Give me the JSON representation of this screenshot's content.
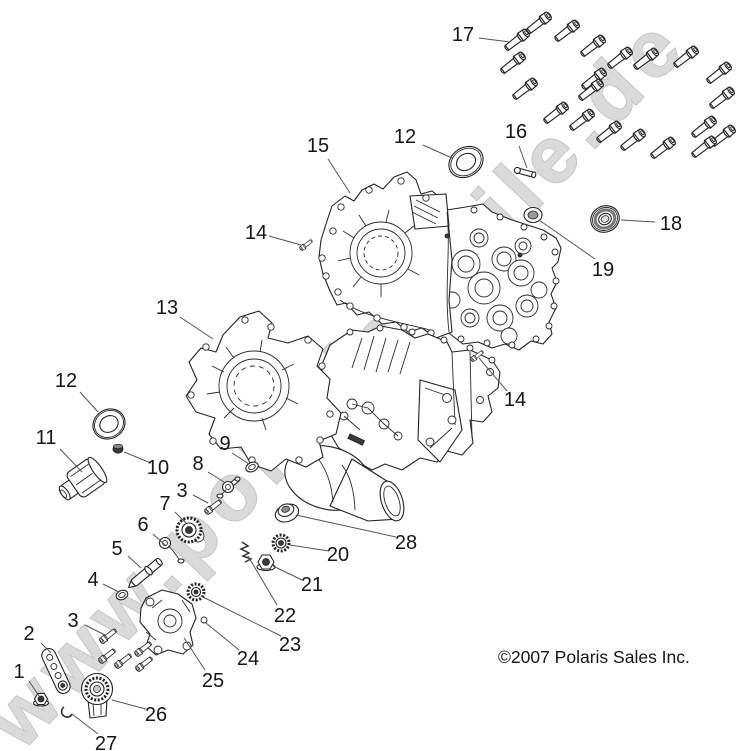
{
  "watermark": {
    "text": "www.polaris-teile.de"
  },
  "footer": {
    "copyright": "©2007 Polaris Sales Inc."
  },
  "diagram": {
    "title": "Polaris crankcase exploded parts diagram",
    "callouts": [
      {
        "n": "17",
        "lx": 463,
        "ly": 35,
        "x1": 479,
        "y1": 38,
        "x2": 510,
        "y2": 42
      },
      {
        "n": "12",
        "lx": 405,
        "ly": 137,
        "x1": 423,
        "y1": 145,
        "x2": 452,
        "y2": 158
      },
      {
        "n": "16",
        "lx": 516,
        "ly": 132,
        "x1": 519,
        "y1": 146,
        "x2": 527,
        "y2": 168
      },
      {
        "n": "15",
        "lx": 318,
        "ly": 146,
        "x1": 328,
        "y1": 159,
        "x2": 350,
        "y2": 193
      },
      {
        "n": "14",
        "lx": 256,
        "ly": 233,
        "x1": 269,
        "y1": 236,
        "x2": 301,
        "y2": 245
      },
      {
        "n": "18",
        "lx": 671,
        "ly": 224,
        "x1": 655,
        "y1": 222,
        "x2": 621,
        "y2": 220
      },
      {
        "n": "19",
        "lx": 603,
        "ly": 270,
        "x1": 595,
        "y1": 259,
        "x2": 539,
        "y2": 220
      },
      {
        "n": "13",
        "lx": 167,
        "ly": 308,
        "x1": 180,
        "y1": 317,
        "x2": 213,
        "y2": 339
      },
      {
        "n": "12",
        "lx": 66,
        "ly": 381,
        "x1": 80,
        "y1": 392,
        "x2": 98,
        "y2": 412
      },
      {
        "n": "11",
        "lx": 46,
        "ly": 438,
        "x1": 60,
        "y1": 449,
        "x2": 82,
        "y2": 472
      },
      {
        "n": "10",
        "lx": 158,
        "ly": 468,
        "x1": 151,
        "y1": 463,
        "x2": 124,
        "y2": 452
      },
      {
        "n": "9",
        "lx": 225,
        "ly": 444,
        "x1": 232,
        "y1": 453,
        "x2": 249,
        "y2": 464
      },
      {
        "n": "8",
        "lx": 198,
        "ly": 464,
        "x1": 208,
        "y1": 472,
        "x2": 224,
        "y2": 482
      },
      {
        "n": "3",
        "lx": 182,
        "ly": 491,
        "x1": 193,
        "y1": 495,
        "x2": 208,
        "y2": 503
      },
      {
        "n": "7",
        "lx": 165,
        "ly": 504,
        "x1": 175,
        "y1": 512,
        "x2": 186,
        "y2": 523
      },
      {
        "n": "6",
        "lx": 143,
        "ly": 525,
        "x1": 153,
        "y1": 534,
        "x2": 166,
        "y2": 546
      },
      {
        "n": "5",
        "lx": 117,
        "ly": 549,
        "x1": 128,
        "y1": 556,
        "x2": 141,
        "y2": 568
      },
      {
        "n": "4",
        "lx": 93,
        "ly": 580,
        "x1": 103,
        "y1": 584,
        "x2": 119,
        "y2": 592
      },
      {
        "n": "28",
        "lx": 406,
        "ly": 543,
        "x1": 396,
        "y1": 537,
        "x2": 296,
        "y2": 515
      },
      {
        "n": "20",
        "lx": 338,
        "ly": 555,
        "x1": 329,
        "y1": 551,
        "x2": 290,
        "y2": 545
      },
      {
        "n": "21",
        "lx": 312,
        "ly": 585,
        "x1": 302,
        "y1": 580,
        "x2": 273,
        "y2": 566
      },
      {
        "n": "22",
        "lx": 285,
        "ly": 616,
        "x1": 277,
        "y1": 605,
        "x2": 248,
        "y2": 556
      },
      {
        "n": "23",
        "lx": 290,
        "ly": 645,
        "x1": 281,
        "y1": 636,
        "x2": 201,
        "y2": 596
      },
      {
        "n": "24",
        "lx": 248,
        "ly": 659,
        "x1": 239,
        "y1": 650,
        "x2": 206,
        "y2": 623
      },
      {
        "n": "25",
        "lx": 213,
        "ly": 681,
        "x1": 205,
        "y1": 670,
        "x2": 184,
        "y2": 638
      },
      {
        "n": "26",
        "lx": 156,
        "ly": 715,
        "x1": 146,
        "y1": 709,
        "x2": 112,
        "y2": 700
      },
      {
        "n": "27",
        "lx": 106,
        "ly": 744,
        "x1": 98,
        "y1": 734,
        "x2": 72,
        "y2": 714
      },
      {
        "n": "2",
        "lx": 29,
        "ly": 634,
        "x1": 41,
        "y1": 643,
        "x2": 51,
        "y2": 653
      },
      {
        "n": "3",
        "lx": 73,
        "ly": 621,
        "x1": 85,
        "y1": 625,
        "x2": 105,
        "y2": 635
      },
      {
        "n": "1",
        "lx": 19,
        "ly": 672,
        "x1": 29,
        "y1": 681,
        "x2": 39,
        "y2": 696
      },
      {
        "n": "14",
        "lx": 515,
        "ly": 400,
        "x1": 507,
        "y1": 391,
        "x2": 479,
        "y2": 358
      }
    ],
    "bolts": [
      {
        "name": "case-bolt",
        "rot": -38,
        "scale": 1.05,
        "positions": [
          [
            517,
            40
          ],
          [
            539,
            23
          ],
          [
            567,
            31
          ],
          [
            513,
            63
          ],
          [
            593,
            46
          ],
          [
            620,
            58
          ],
          [
            646,
            59
          ],
          [
            686,
            57
          ],
          [
            719,
            73
          ],
          [
            525,
            89
          ],
          [
            594,
            79
          ],
          [
            591,
            90
          ],
          [
            722,
            98
          ],
          [
            556,
            113
          ],
          [
            582,
            120
          ],
          [
            609,
            132
          ],
          [
            633,
            140
          ],
          [
            663,
            148
          ],
          [
            704,
            127
          ],
          [
            723,
            136
          ],
          [
            704,
            147
          ]
        ]
      },
      {
        "name": "pump-bolt",
        "rot": 142,
        "scale": 0.72,
        "positions": [
          [
            108,
            636
          ],
          [
            107,
            656
          ],
          [
            123,
            661
          ],
          [
            143,
            649
          ],
          [
            144,
            664
          ],
          [
            213,
            507
          ]
        ]
      },
      {
        "name": "dowel-bolt",
        "rot": 142,
        "scale": 0.55,
        "positions": [
          [
            306,
            245
          ],
          [
            477,
            356
          ]
        ]
      }
    ]
  }
}
